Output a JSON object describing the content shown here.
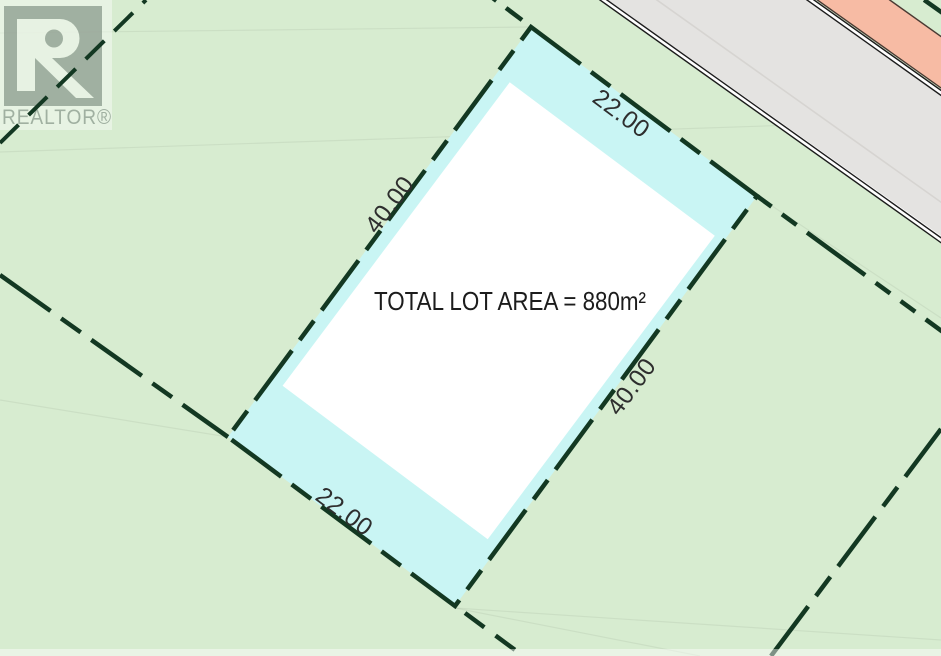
{
  "watermark": {
    "brand": "REALTOR®",
    "logo_letter": "R"
  },
  "map": {
    "area_label": "TOTAL LOT AREA = 880m²",
    "dimensions": {
      "top": "22.00",
      "right": "40.00",
      "bottom": "22.00",
      "left": "40.00"
    }
  },
  "colors": {
    "background": "#d7ecd0",
    "lot_fill": "#c9f5f4",
    "lot_interior": "#ffffff",
    "boundary_green": "#133822",
    "road_surface": "#e4e3e1",
    "road_edge_dark": "#1c1c1c",
    "boulevard_pink": "#f7bba4",
    "label_text": "#2e2e2e",
    "watermark_gray": "#99a89b"
  }
}
